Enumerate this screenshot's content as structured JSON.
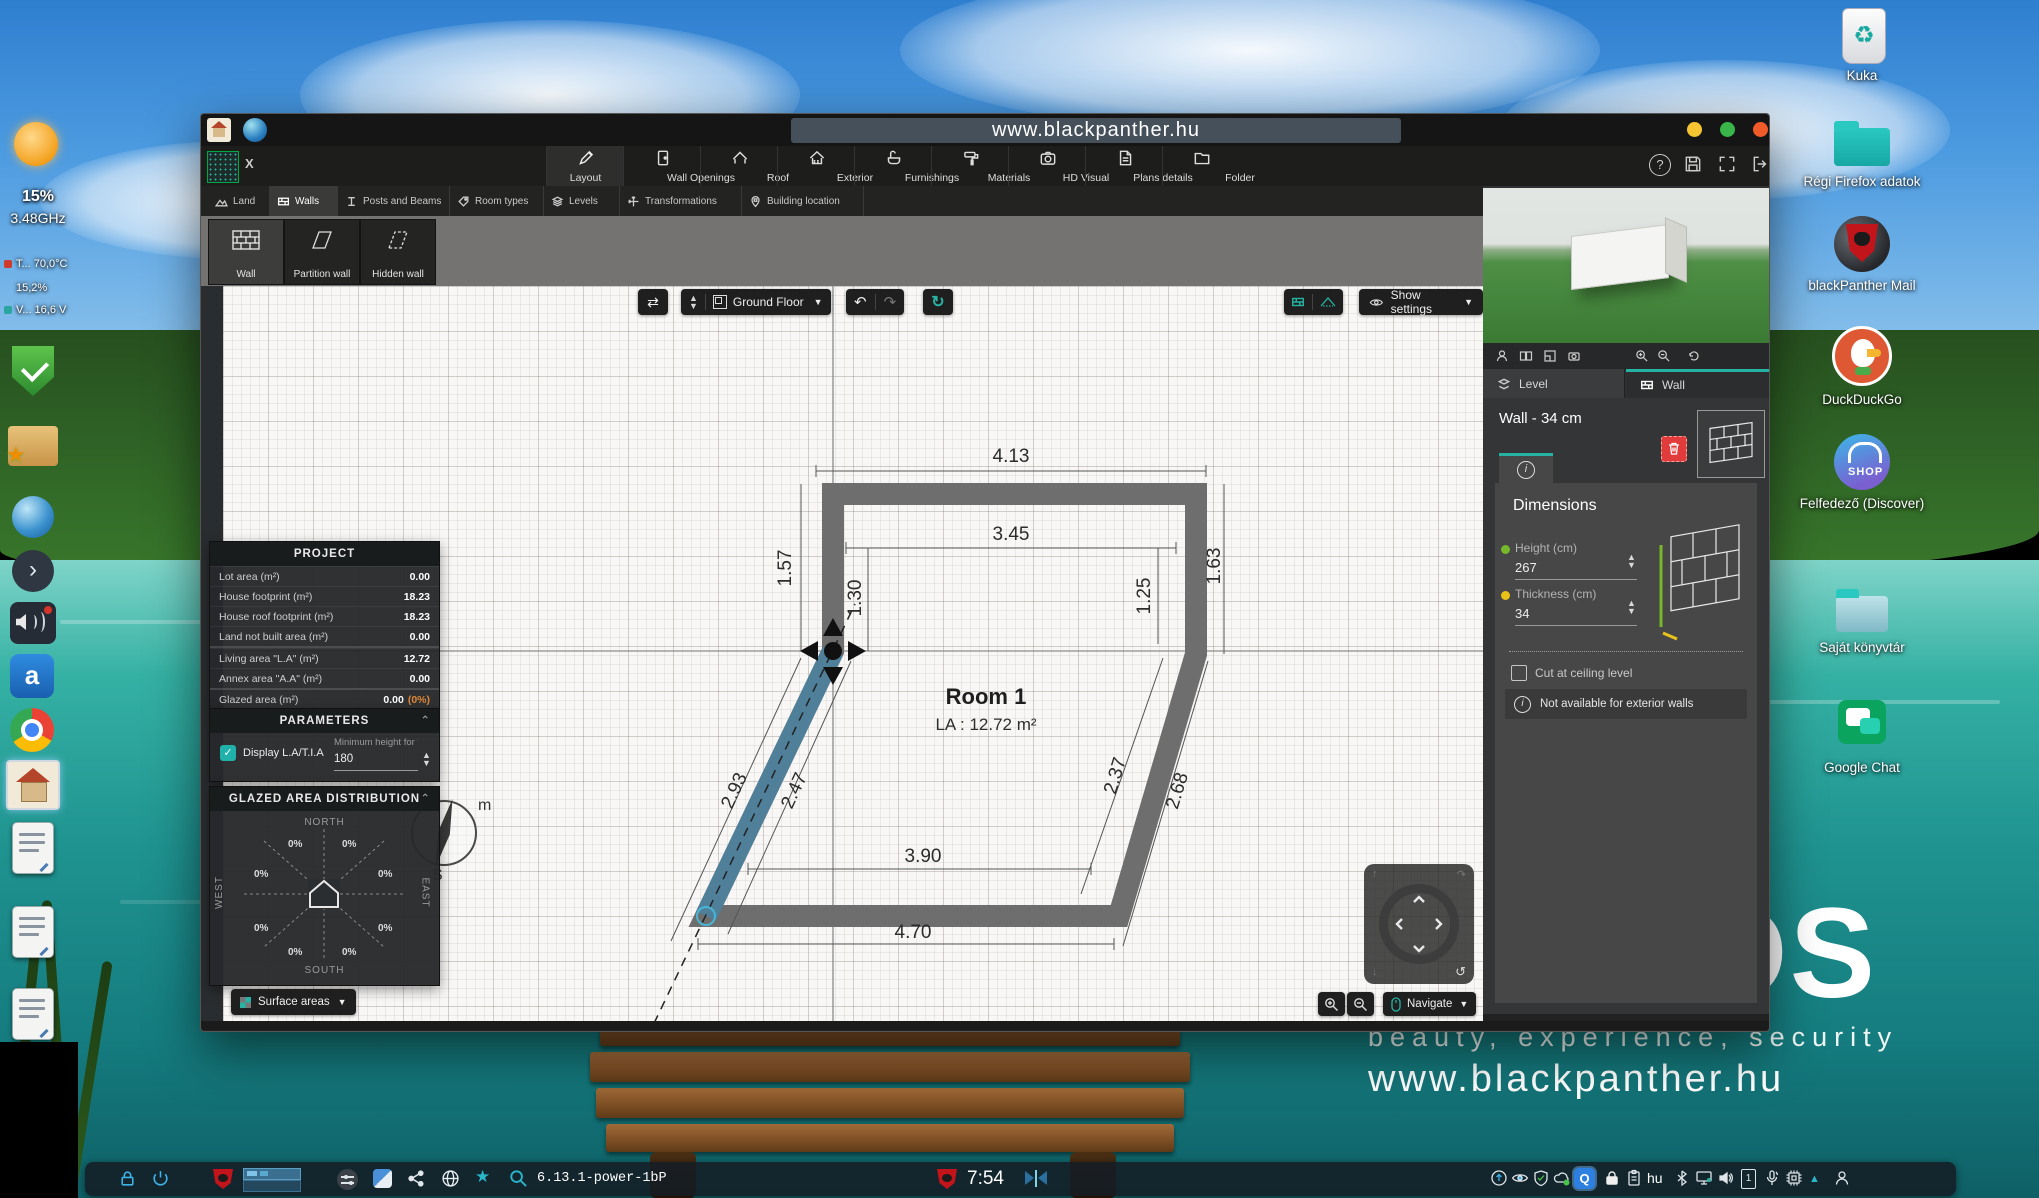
{
  "desktop": {
    "watermark": {
      "os": "OS",
      "tagline": "beauty, experience, security",
      "url": "www.blackpanther.hu"
    },
    "icons": {
      "trash": "Kuka",
      "old_firefox": "Régi Firefox adatok",
      "mail": "blackPanther Mail",
      "duckduckgo": "DuckDuckGo",
      "discover": "Felfedező (Discover)",
      "discover_badge": "SHOP",
      "home_library": "Saját könyvtár",
      "gchat": "Google Chat"
    },
    "dock": {
      "battery": "15%",
      "cpu": "3.48GHz",
      "temp": "T... 70,0°C",
      "load": "15,2%",
      "volt": "V... 16,6 V",
      "app_letter": "a"
    },
    "taskbar": {
      "kernel": "6.13.1-power-1bP",
      "time": "7:54",
      "layout": "hu",
      "q_letter": "Q",
      "device_badge": "1"
    }
  },
  "window": {
    "title": "www.blackpanther.hu",
    "close": "X",
    "menu": [
      "Layout",
      "Wall Openings",
      "Roof",
      "Exterior",
      "Furnishings",
      "Materials",
      "HD Visual",
      "Plans details",
      "Folder"
    ],
    "subtabs": [
      "Land",
      "Walls",
      "Posts and Beams",
      "Room types",
      "Levels",
      "Transformations",
      "Building location"
    ],
    "tools": [
      "Wall",
      "Partition wall",
      "Hidden wall"
    ],
    "canvas": {
      "floor": "Ground Floor",
      "show_settings": "Show settings",
      "navigate": "Navigate",
      "surface_areas": "Surface areas",
      "undo": "↶",
      "redo": "↷",
      "swap": "⇄",
      "refresh": "↻",
      "compass_m": "m",
      "compass_s": "S"
    },
    "plan": {
      "room": "Room 1",
      "area": "LA : 12.72 m²",
      "dims": [
        "4.13",
        "3.45",
        "1.57",
        "1.30",
        "1.25",
        "1.63",
        "2.93",
        "2.47",
        "2.37",
        "2.68",
        "3.90",
        "4.70"
      ]
    },
    "project": {
      "title": "PROJECT",
      "rows": [
        {
          "l": "Lot area (m²)",
          "v": "0.00"
        },
        {
          "l": "House footprint (m²)",
          "v": "18.23"
        },
        {
          "l": "House roof footprint (m²)",
          "v": "18.23"
        },
        {
          "l": "Land not built area (m²)",
          "v": "0.00"
        },
        {
          "l": "Living area \"L.A\" (m²)",
          "v": "12.72"
        },
        {
          "l": "Annex area \"A.A\" (m²)",
          "v": "0.00"
        },
        {
          "l": "Glazed area (m²)",
          "v": "0.00"
        }
      ],
      "glazed_pct": "(0%)"
    },
    "parameters": {
      "title": "PARAMETERS",
      "display": "Display L.A/T.I.A",
      "min_height_label": "Minimum height for \"L...",
      "min_height_value": "180"
    },
    "glazed": {
      "title": "GLAZED AREA DISTRIBUTION",
      "north": "NORTH",
      "south": "SOUTH",
      "west": "WEST",
      "east": "EAST",
      "pct": "0%"
    },
    "right_panel": {
      "tab_level": "Level",
      "tab_wall": "Wall",
      "heading": "Wall - 34 cm",
      "info_i": "i",
      "dimensions": "Dimensions",
      "height_label": "Height (cm)",
      "height_value": "267",
      "thickness_label": "Thickness (cm)",
      "thickness_value": "34",
      "cut": "Cut at ceiling level",
      "note": "Not available for exterior walls"
    },
    "colors": {
      "accent": "#27b3a3",
      "selected_wall": "#4f7f99",
      "glazed_pct_color": "#e0883a"
    }
  }
}
